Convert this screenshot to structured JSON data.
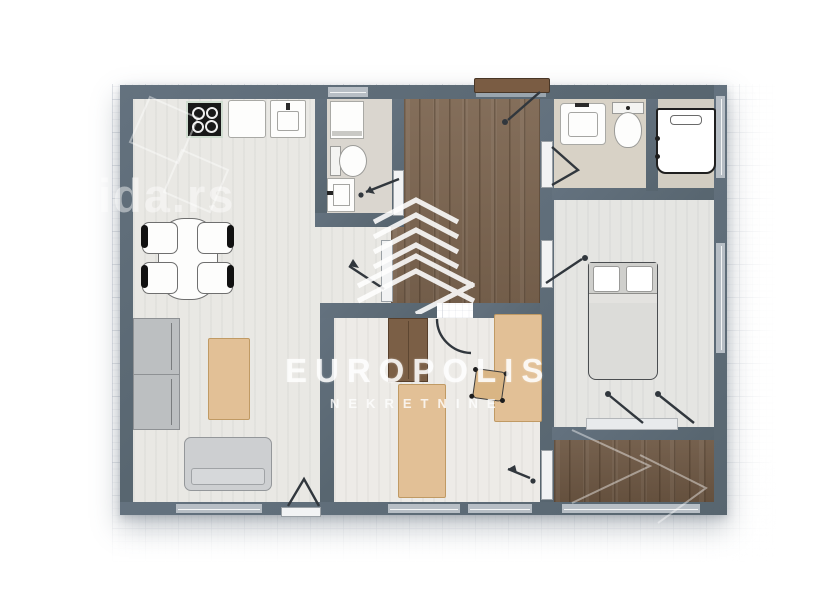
{
  "watermark": {
    "brand": "EUROPOLIS",
    "subtitle": "NEKRETNINE",
    "site_fragment": "ida.rs"
  },
  "palette": {
    "wall": "#5d6b79",
    "window": "#b7bec5",
    "hall_wood": "#7c6550",
    "terrace_wood": "#6d5743",
    "floor_light": "#e9e8e4",
    "floor_greige": "#dad6cf",
    "floor_bedroom": "#e5e5e2",
    "tan_furniture": "#e2c096",
    "gray_furniture": "#cdcfd1",
    "watermark_white": "#ffffff"
  },
  "rooms": [
    {
      "name": "living-room-kitchen",
      "furniture": [
        "stove",
        "kitchen-counter",
        "kitchen-sink",
        "dining-table",
        "dining-chair",
        "cabinet",
        "coffee-table",
        "sofa"
      ]
    },
    {
      "name": "bathroom-1",
      "furniture": [
        "washing-machine",
        "toilet",
        "washbasin"
      ]
    },
    {
      "name": "entry-hall",
      "furniture": [
        "entry-door"
      ]
    },
    {
      "name": "bathroom-2",
      "furniture": [
        "washbasin",
        "toilet"
      ]
    },
    {
      "name": "utility-room",
      "furniture": [
        "shower-unit"
      ]
    },
    {
      "name": "bedroom",
      "furniture": [
        "double-bed",
        "balcony-door"
      ]
    },
    {
      "name": "second-room",
      "furniture": [
        "wardrobe",
        "single-bed",
        "desk-bed",
        "chair"
      ]
    },
    {
      "name": "terrace",
      "furniture": []
    }
  ]
}
